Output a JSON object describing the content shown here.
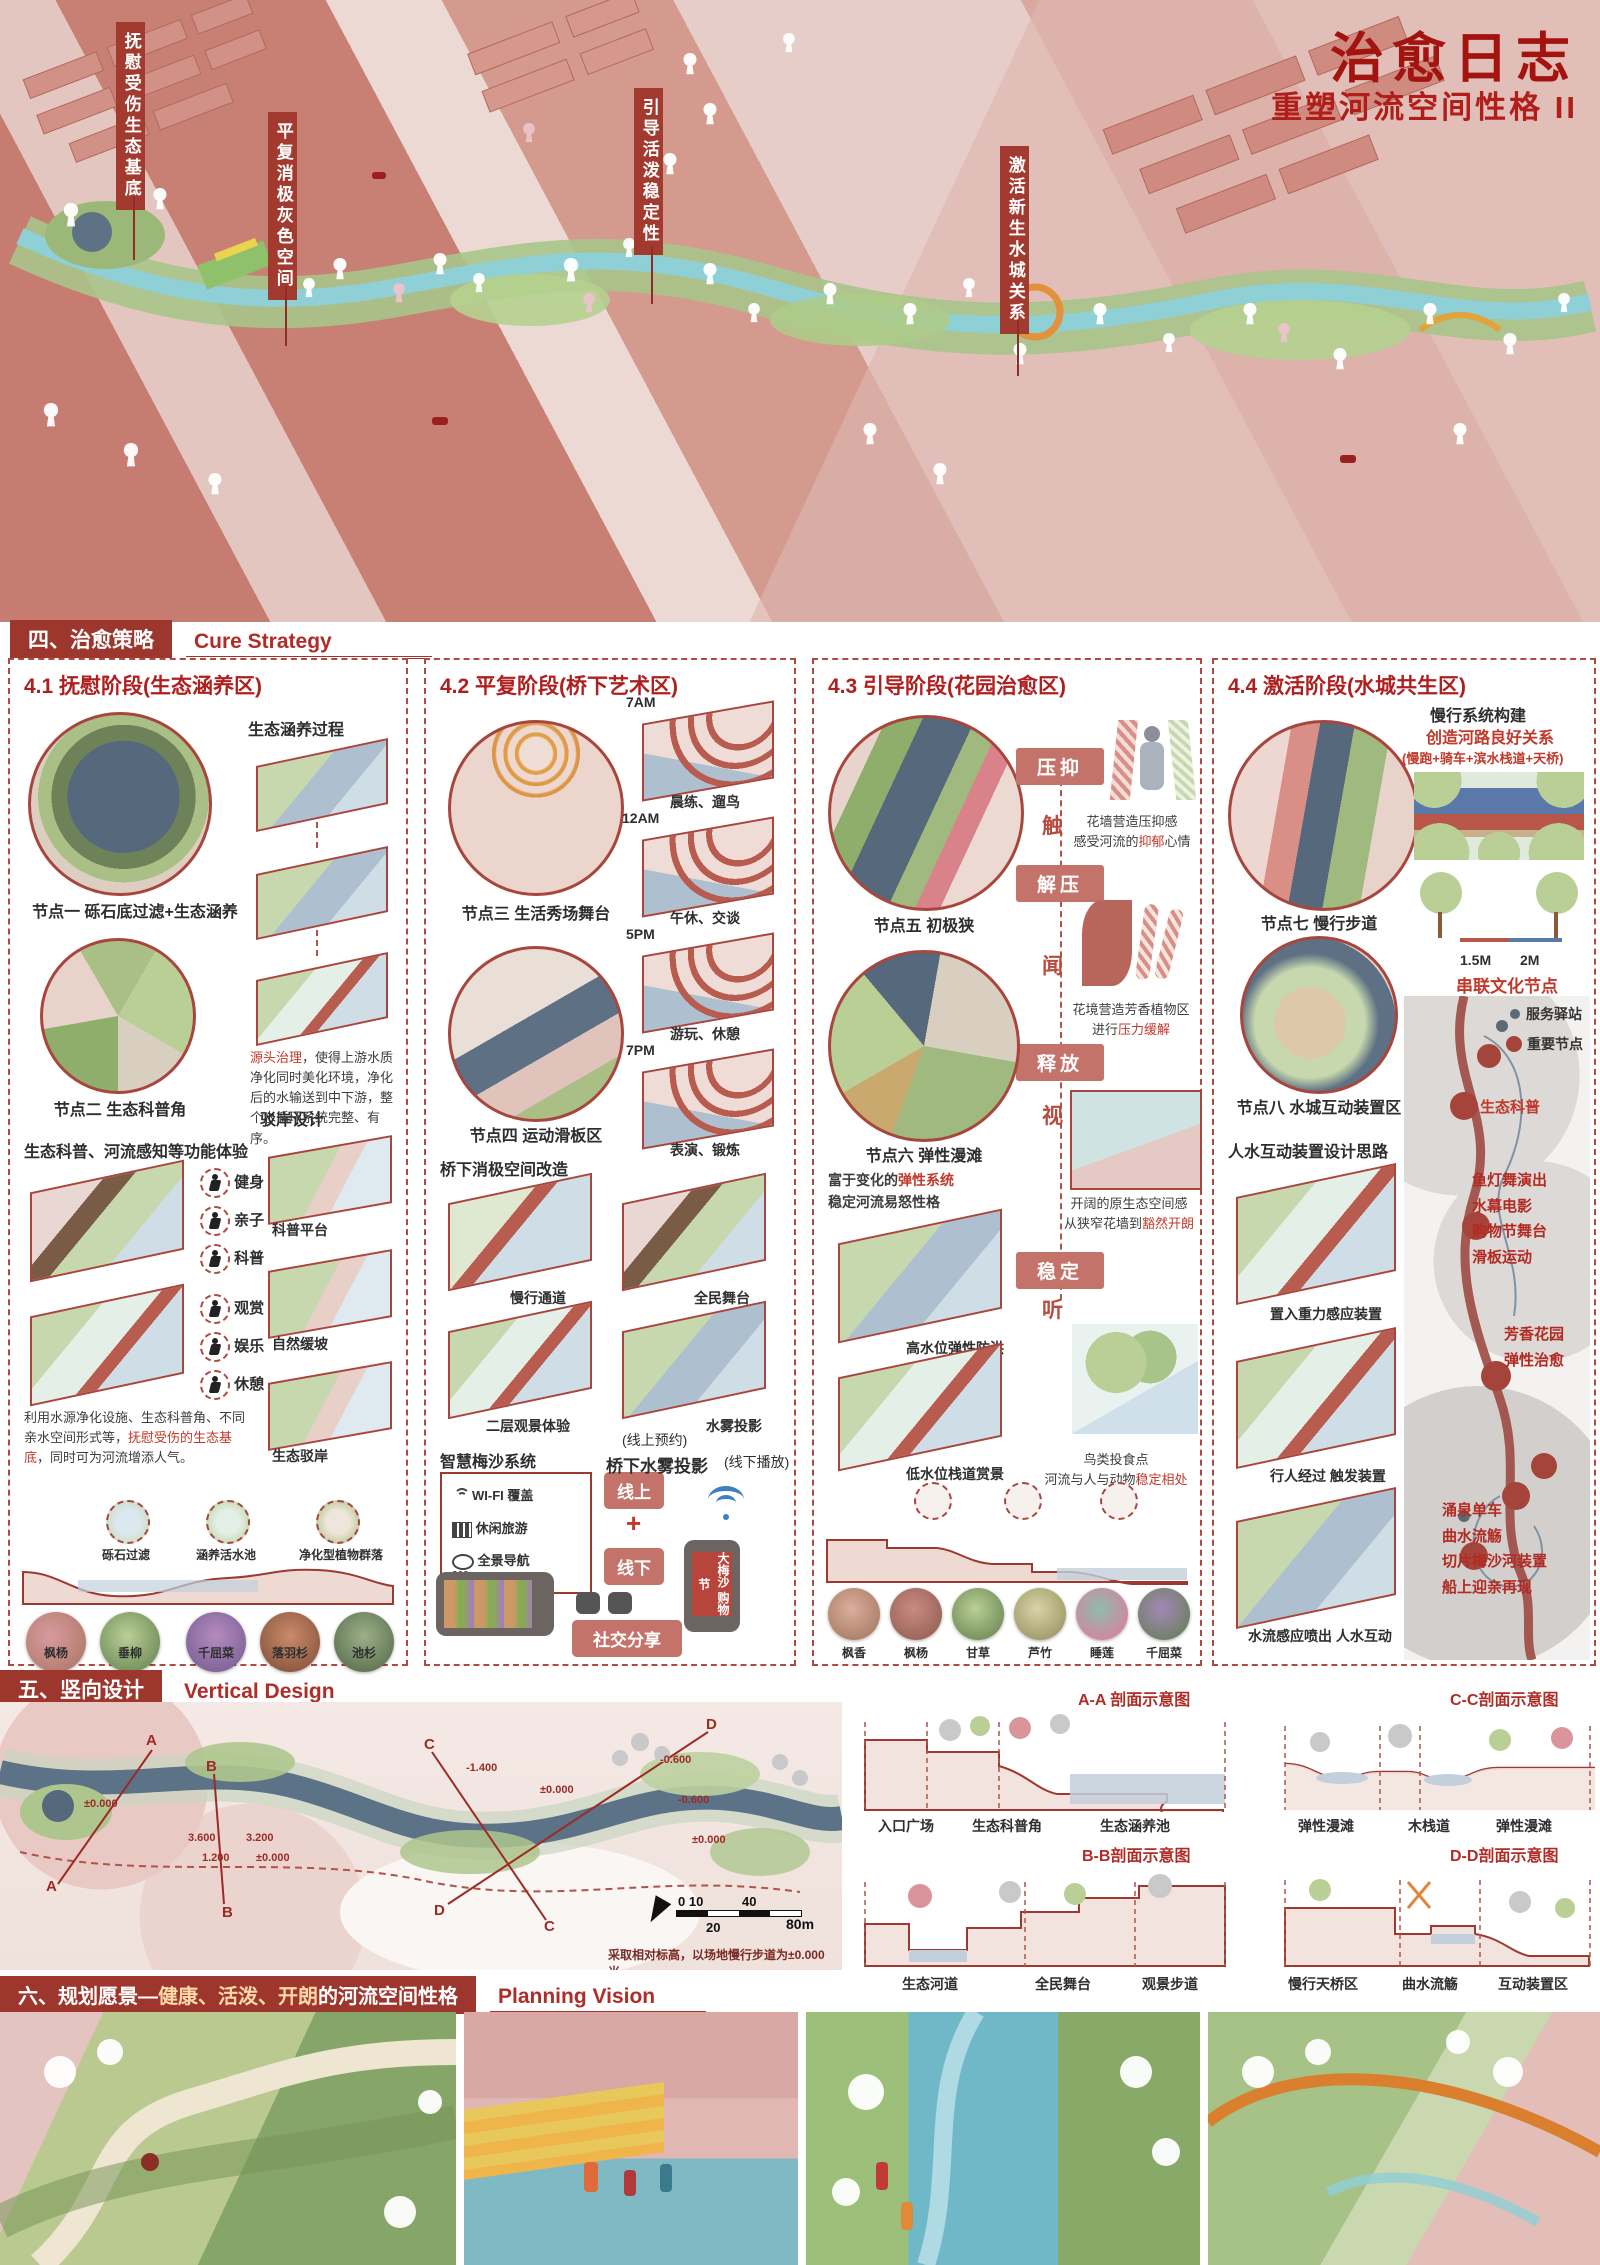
{
  "poster": {
    "title": "治愈日志",
    "subtitle": "重塑河流空间性格 II"
  },
  "hero": {
    "labels": [
      "抚慰受伤生态基底",
      "平复消极灰色空间",
      "引导活泼稳定性",
      "激活新生水城关系"
    ]
  },
  "sec4": {
    "cn": "四、治愈策略",
    "en": "Cure Strategy"
  },
  "sec5": {
    "cn": "五、竖向设计",
    "en": "Vertical Design"
  },
  "sec6": {
    "cn": "六、规划愿景—",
    "hl": "健康、活泼、开朗",
    "cn2": "的河流空间性格",
    "en": "Planning Vision"
  },
  "col1": {
    "title": "4.1 抚慰阶段(生态涵养区)",
    "process": "生态涵养过程",
    "node1": "节点一 砾石底过滤+生态涵养",
    "p1_red": "源头治理",
    "p1": "，使得上游水质净化同时美化环境，净化后的水输送到中下游，整个水循环系统完整、有序。",
    "node2": "节点二 生态科普角",
    "revetment": "驳岸设计",
    "rev_labels": [
      "科普平台",
      "自然缓坡",
      "生态驳岸"
    ],
    "exp": "生态科普、河流感知等功能体验",
    "acts": [
      "健身",
      "亲子",
      "科普",
      "观赏",
      "娱乐",
      "休憩"
    ],
    "p2a": "利用水源净化设施、生态科普角、不同亲水空间形式等，",
    "p2_red": "抚慰受伤的生态基底",
    "p2b": "，同时可为河流增添人气。",
    "sec_labels": [
      "砾石过滤",
      "涵养活水池",
      "净化型植物群落"
    ],
    "plants": [
      "枫杨",
      "垂柳",
      "千屈菜",
      "落羽杉",
      "池杉"
    ]
  },
  "col2": {
    "title": "4.2 平复阶段(桥下艺术区)",
    "node3": "节点三 生活秀场舞台",
    "node4": "节点四 运动滑板区",
    "times": [
      {
        "t": "7AM",
        "a": "晨练、遛鸟"
      },
      {
        "t": "12AM",
        "a": "午休、交谈"
      },
      {
        "t": "5PM",
        "a": "游玩、休憩"
      },
      {
        "t": "7PM",
        "a": "表演、锻炼"
      }
    ],
    "renov": "桥下消极空间改造",
    "renov_labels": [
      "慢行通道",
      "全民舞台",
      "二层观景体验",
      "水雾投影"
    ],
    "smart": "智慧梅沙系统",
    "smart_items": [
      "WI-FI 覆盖",
      "休闲旅游",
      "全景导航"
    ],
    "deg": "360",
    "online": "线上",
    "plus": "+",
    "offline": "线下",
    "share": "社交分享",
    "reserve": "(线上预约)",
    "fog": "桥下水雾投影",
    "play": "(线下播放)",
    "phone": "大梅沙 购物节"
  },
  "col3": {
    "title": "4.3 引导阶段(花园治愈区)",
    "node5": "节点五 初极狭",
    "node6": "节点六 弹性漫滩",
    "badges": [
      "压抑",
      "解压",
      "释放",
      "稳定"
    ],
    "senses": [
      "触",
      "闻",
      "视",
      "听"
    ],
    "b1a": "花墙营造压抑感",
    "b1b": "感受河流的",
    "b1r": "抑郁",
    "b1c": "心情",
    "b2a": "花境营造芳香植物区",
    "b2b": "进行",
    "b2r": "压力缓解",
    "b3a": "开阔的原生态空间感",
    "b3b": "从狭窄花墙到",
    "b3r": "豁然开朗",
    "b4a": "鸟类投食点",
    "b4b": "河流与人与动物",
    "b4r": "稳定相处",
    "e1": "富于变化的",
    "e1r": "弹性系统",
    "e2": "稳定河流易怒性格",
    "flood": "高水位弹性防洪",
    "walk": "低水位栈道赏景",
    "plants": [
      "枫香",
      "枫杨",
      "甘草",
      "芦竹",
      "睡莲",
      "千屈菜"
    ]
  },
  "col4": {
    "title": "4.4 激活阶段(水城共生区)",
    "slow1": "慢行系统构建",
    "slow2": "创造河路良好关系",
    "slow3": "(慢跑+骑车+滨水栈道+天桥)",
    "dim1": "1.5M",
    "dim2": "2M",
    "culture": "串联文化节点",
    "map_node": "生态科普",
    "legend1": "服务驿站",
    "legend2": "重要节点",
    "ev1": [
      "鱼灯舞演出",
      "水幕电影",
      "购物节舞台",
      "滑板运动"
    ],
    "ev2": [
      "芳香花园",
      "弹性治愈"
    ],
    "ev3": [
      "涌泉单车",
      "曲水流觞",
      "切片梅沙河装置",
      "船上迎亲再现"
    ],
    "node7": "节点七 慢行步道",
    "node8": "节点八 水城互动装置区",
    "idea": "人水互动装置设计思路",
    "s1": "置入重力感应装置",
    "s2": "行人经过 触发装置",
    "s3": "水流感应喷出 人水互动"
  },
  "v": {
    "elev": [
      "±0.000",
      "3.600",
      "3.200",
      "1.200",
      "±0.000",
      "-1.400",
      "±0.000",
      "-0.600",
      "-0.600",
      "±0.000"
    ],
    "cuts": [
      "A",
      "B",
      "C",
      "D"
    ],
    "scale": [
      "0 10",
      "40",
      "20",
      "80m"
    ],
    "note": "采取相对标高，以场地慢行步道为±0.000米。",
    "aa": {
      "t": "A-A 剖面示意图",
      "l": [
        "入口广场",
        "生态科普角",
        "生态涵养池"
      ]
    },
    "bb": {
      "t": "B-B剖面示意图",
      "l": [
        "生态河道",
        "全民舞台",
        "观景步道"
      ]
    },
    "cc": {
      "t": "C-C剖面示意图",
      "l": [
        "弹性漫滩",
        "木栈道",
        "弹性漫滩"
      ]
    },
    "dd": {
      "t": "D-D剖面示意图",
      "l": [
        "慢行天桥区",
        "曲水流觞",
        "互动装置区"
      ]
    }
  }
}
